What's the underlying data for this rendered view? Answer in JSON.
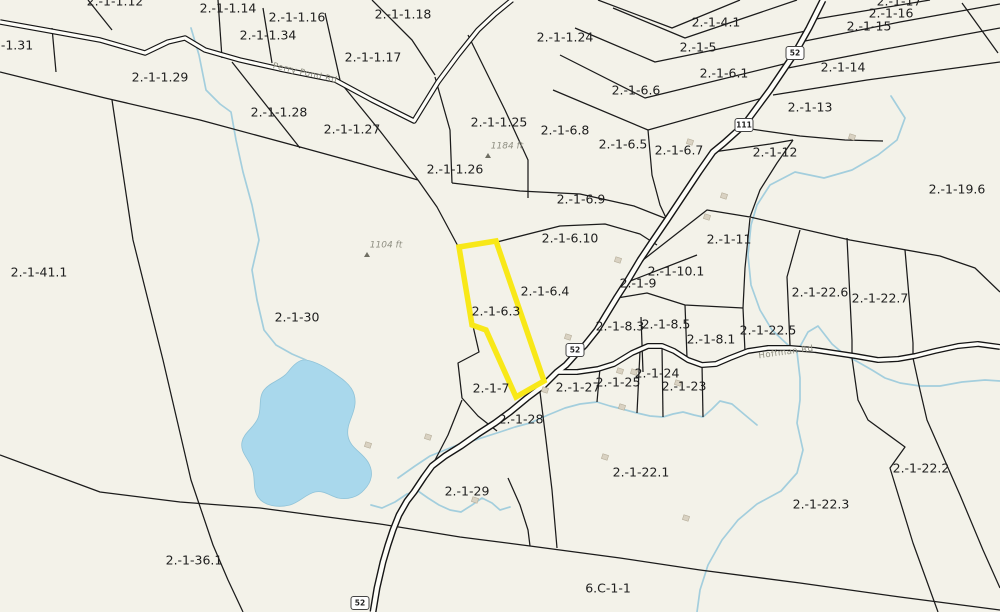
{
  "map": {
    "title": "Tax parcel map",
    "highlighted_parcel": "2.-1-6.3",
    "colors": {
      "background": "#f3f2e9",
      "boundary": "#1b1b1b",
      "highlight": "#f8e818",
      "road_fill": "#fdfdf8",
      "road_casing": "#151515",
      "water": "#a3cedd",
      "pond_fill": "#a9d8ec",
      "building": "#d9d2c2",
      "label": "#1e1e1e"
    },
    "parcel_labels": [
      {
        "text": "2.-1-1.12",
        "x": 115,
        "y": 2
      },
      {
        "text": "2.-1-1.14",
        "x": 228,
        "y": 9
      },
      {
        "text": "2.-1-1.16",
        "x": 297,
        "y": 18
      },
      {
        "text": "2.-1-1.34",
        "x": 268,
        "y": 36
      },
      {
        "text": "2.-1-1.18",
        "x": 403,
        "y": 15
      },
      {
        "text": "2.-1-1.24",
        "x": 565,
        "y": 38
      },
      {
        "text": "2.-1-4.1",
        "x": 716,
        "y": 23
      },
      {
        "text": "2.-1-17",
        "x": 899,
        "y": 2
      },
      {
        "text": "2.-1-16",
        "x": 891,
        "y": 14
      },
      {
        "text": "2.-1-15",
        "x": 869,
        "y": 27
      },
      {
        "text": "-1.31",
        "x": 17,
        "y": 46
      },
      {
        "text": "2.-1-5",
        "x": 698,
        "y": 48
      },
      {
        "text": "2.-1-1.29",
        "x": 160,
        "y": 78
      },
      {
        "text": "2.-1-1.17",
        "x": 373,
        "y": 58
      },
      {
        "text": "2.-1-14",
        "x": 843,
        "y": 68
      },
      {
        "text": "2.-1-6.1",
        "x": 724,
        "y": 74
      },
      {
        "text": "2.-1-6.6",
        "x": 636,
        "y": 91
      },
      {
        "text": "2.-1-13",
        "x": 810,
        "y": 108
      },
      {
        "text": "2.-1-1.28",
        "x": 279,
        "y": 113
      },
      {
        "text": "2.-1-1.25",
        "x": 499,
        "y": 123
      },
      {
        "text": "2.-1-1.27",
        "x": 352,
        "y": 130
      },
      {
        "text": "2.-1-6.8",
        "x": 565,
        "y": 131
      },
      {
        "text": "2.-1-6.5",
        "x": 623,
        "y": 145
      },
      {
        "text": "2.-1-6.7",
        "x": 679,
        "y": 151
      },
      {
        "text": "2.-1-12",
        "x": 775,
        "y": 153
      },
      {
        "text": "2.-1-1.26",
        "x": 455,
        "y": 170
      },
      {
        "text": "2.-1-19.6",
        "x": 957,
        "y": 190
      },
      {
        "text": "2.-1-6.9",
        "x": 581,
        "y": 200
      },
      {
        "text": "2.-1-6.10",
        "x": 570,
        "y": 239
      },
      {
        "text": "2.-1-11",
        "x": 729,
        "y": 240
      },
      {
        "text": "2.-1-41.1",
        "x": 39,
        "y": 273
      },
      {
        "text": "2.-1-10.1",
        "x": 676,
        "y": 272
      },
      {
        "text": "2.-1-9",
        "x": 638,
        "y": 284
      },
      {
        "text": "2.-1-6.4",
        "x": 545,
        "y": 292
      },
      {
        "text": "2.-1-22.6",
        "x": 820,
        "y": 293
      },
      {
        "text": "2.-1-22.7",
        "x": 880,
        "y": 299
      },
      {
        "text": "2.-1-6.3",
        "x": 496,
        "y": 312
      },
      {
        "text": "2.-1-30",
        "x": 297,
        "y": 318
      },
      {
        "text": "2.-1-8.5",
        "x": 666,
        "y": 325
      },
      {
        "text": "2.-1-8.3",
        "x": 620,
        "y": 327
      },
      {
        "text": "2.-1-22.5",
        "x": 768,
        "y": 331
      },
      {
        "text": "2.-1-8.1",
        "x": 711,
        "y": 340
      },
      {
        "text": "2.-1-24",
        "x": 657,
        "y": 374
      },
      {
        "text": "2.-1-25",
        "x": 618,
        "y": 383
      },
      {
        "text": "2.-1-23",
        "x": 684,
        "y": 387
      },
      {
        "text": "2.-1-27",
        "x": 578,
        "y": 388
      },
      {
        "text": "2.-1-7",
        "x": 491,
        "y": 389
      },
      {
        "text": "2.-1-28",
        "x": 521,
        "y": 420
      },
      {
        "text": "2.-1-22.1",
        "x": 641,
        "y": 473
      },
      {
        "text": "2.-1-22.2",
        "x": 921,
        "y": 469
      },
      {
        "text": "2.-1-29",
        "x": 467,
        "y": 492
      },
      {
        "text": "2.-1-22.3",
        "x": 821,
        "y": 505
      },
      {
        "text": "2.-1-36.1",
        "x": 194,
        "y": 561
      },
      {
        "text": "6.C-1-1",
        "x": 608,
        "y": 589
      }
    ],
    "road_labels": [
      {
        "text": "Perry Pond Rd",
        "x": 305,
        "y": 73,
        "angle": 13
      },
      {
        "text": "Hoffman Rd",
        "x": 786,
        "y": 352,
        "angle": -8
      }
    ],
    "route_shields": [
      {
        "text": "52",
        "x": 795,
        "y": 53
      },
      {
        "text": "111",
        "x": 744,
        "y": 125
      },
      {
        "text": "52",
        "x": 575,
        "y": 350
      },
      {
        "text": "52",
        "x": 360,
        "y": 603
      }
    ],
    "elevation_markers": [
      {
        "text": "1104 ft",
        "x": 386,
        "y": 245
      },
      {
        "text": "1184 ft",
        "x": 507,
        "y": 146
      }
    ]
  }
}
